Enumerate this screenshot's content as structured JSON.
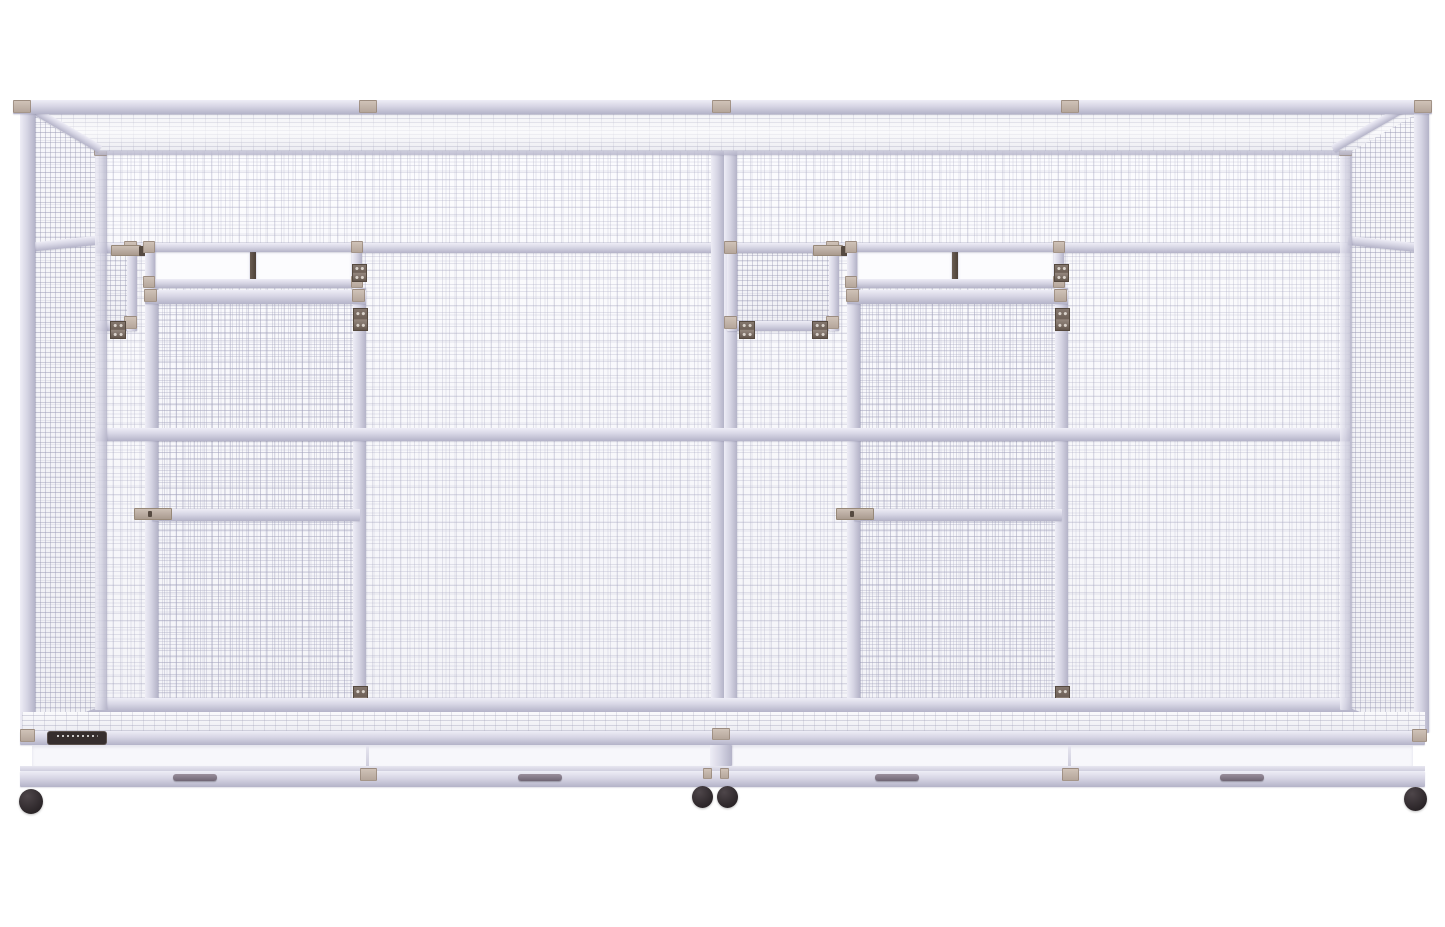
{
  "scene": {
    "subject": "Large double walk-in bird aviary cage, front product view on white background",
    "units": 2
  },
  "components": {
    "feeder_doors": {
      "count": 2,
      "hinges_each": 2,
      "latch_each": 1
    },
    "nest_box_windows": {
      "count": 2,
      "white_panes_each": 2,
      "hinge_each": 1
    },
    "walk_in_doors": {
      "count": 2,
      "hinges_each": 2,
      "latch_each": 1
    },
    "pull_out_trays": {
      "count": 2,
      "handles_total": 4
    },
    "caster_wheels": {
      "count": 4
    },
    "brand_label": {
      "count": 1,
      "position": "bottom-left",
      "text_legible": false
    }
  },
  "colors": {
    "background": "#ffffff",
    "frame": "#d6d5e4",
    "frame_hi": "#eeedf6",
    "frame_lo": "#b4b3c8",
    "mesh_line": "#a8a8c0",
    "back_tint": "#c9c8da",
    "connector": "#b5a69b",
    "hinge": "#6e6057",
    "mullion": "#564a41",
    "pane": "#fcfcfe",
    "tray": "#f7f7fb",
    "handle": "#6f6574",
    "wheel": "#2b2528",
    "wheel_hi": "#4e464a",
    "label_bg": "#362e2e"
  }
}
